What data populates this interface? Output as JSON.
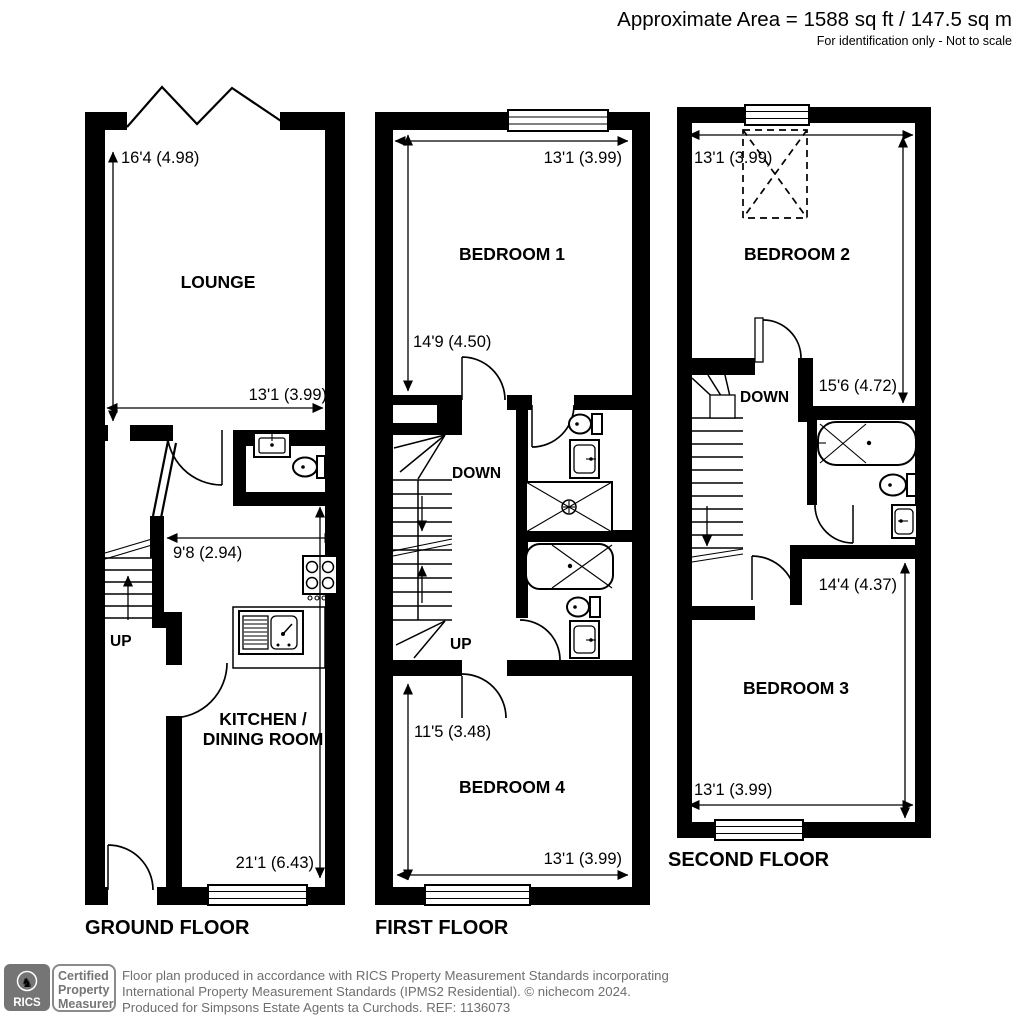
{
  "header": {
    "area": "Approximate Area = 1588 sq ft / 147.5 sq m",
    "note": "For identification only - Not to scale"
  },
  "ground": {
    "label": "GROUND FLOOR",
    "lounge": "LOUNGE",
    "kitchen_line1": "KITCHEN /",
    "kitchen_line2": "DINING ROOM",
    "up": "UP",
    "dim_lounge_height": "16'4 (4.98)",
    "dim_lounge_width": "13'1 (3.99)",
    "dim_kitchen_width": "9'8 (2.94)",
    "dim_kitchen_height": "21'1 (6.43)"
  },
  "first": {
    "label": "FIRST FLOOR",
    "bedroom1": "BEDROOM 1",
    "bedroom4": "BEDROOM 4",
    "down": "DOWN",
    "up": "UP",
    "dim_bedroom1_width": "13'1 (3.99)",
    "dim_bedroom1_height": "14'9 (4.50)",
    "dim_bedroom4_height": "11'5 (3.48)",
    "dim_bedroom4_width": "13'1 (3.99)"
  },
  "second": {
    "label": "SECOND FLOOR",
    "bedroom2": "BEDROOM 2",
    "bedroom3": "BEDROOM 3",
    "down": "DOWN",
    "dim_bedroom2_width": "13'1 (3.99)",
    "dim_bedroom2_height": "15'6 (4.72)",
    "dim_bedroom3_height": "14'4 (4.37)",
    "dim_bedroom3_width": "13'1 (3.99)"
  },
  "footer": {
    "rics": "RICS",
    "badge_line1": "Certified",
    "badge_line2": "Property",
    "badge_line3": "Measurer",
    "text_line1": "Floor plan produced in accordance with RICS Property Measurement Standards incorporating",
    "text_line2": "International Property Measurement Standards (IPMS2 Residential).   © nichecom 2024.",
    "text_line3": "Produced for Simpsons Estate Agents ta Curchods.   REF:  1136073"
  },
  "colors": {
    "wall": "#000000",
    "footer_gray": "#6e6e6e",
    "logo_gray": "#757575"
  }
}
